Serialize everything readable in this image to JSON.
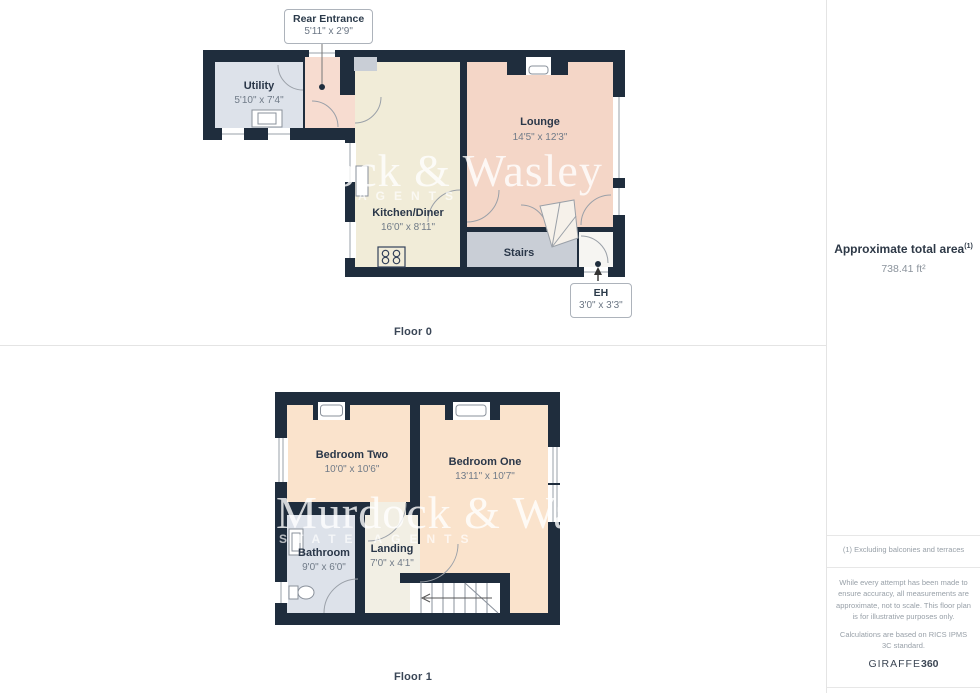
{
  "floor0": {
    "label": "Floor 0",
    "rooms": [
      {
        "name": "Utility",
        "dims": "5'10\" x 7'4\""
      },
      {
        "name": "Kitchen/Diner",
        "dims": "16'0\" x 8'11\""
      },
      {
        "name": "Lounge",
        "dims": "14'5\" x 12'3\""
      },
      {
        "name": "Stairs",
        "dims": ""
      }
    ],
    "callouts": [
      {
        "name": "Rear Entrance",
        "dims": "5'11\" x 2'9\""
      },
      {
        "name": "EH",
        "dims": "3'0\" x 3'3\""
      }
    ]
  },
  "floor1": {
    "label": "Floor 1",
    "rooms": [
      {
        "name": "Bedroom Two",
        "dims": "10'0\" x 10'6\""
      },
      {
        "name": "Bedroom One",
        "dims": "13'11\" x 10'7\""
      },
      {
        "name": "Bathroom",
        "dims": "9'0\" x 6'0\""
      },
      {
        "name": "Landing",
        "dims": "7'0\" x 4'1\""
      }
    ]
  },
  "watermark": {
    "line1": "Murdock & Wasley",
    "floor0_line2": "AGENTS",
    "floor1_line2": "ESTATE AGENTS"
  },
  "sidebar": {
    "area_title": "Approximate total area",
    "area_footnote_marker": "(1)",
    "area_value": "738.41 ft²",
    "footnote": "(1) Excluding balconies and terraces",
    "disclaimer": "While every attempt has been made to ensure accuracy, all measurements are approximate, not to scale. This floor plan is for illustrative purposes only.",
    "standard_note": "Calculations are based on RICS IPMS 3C standard.",
    "brand_name": "GIRAFFE",
    "brand_suffix": "360"
  },
  "colors": {
    "wall": "#1f2d3d",
    "utility": "#dde2ea",
    "bathroom": "#dde2ea",
    "kitchen": "#f1ecd8",
    "lounge": "#f4d6c7",
    "bedroom": "#fae3cc",
    "hall": "#f7dcd0",
    "stairs": "#c9ced6",
    "landing": "#f2efe4",
    "eh": "#f6f5f2",
    "niche": "#ffffff"
  }
}
